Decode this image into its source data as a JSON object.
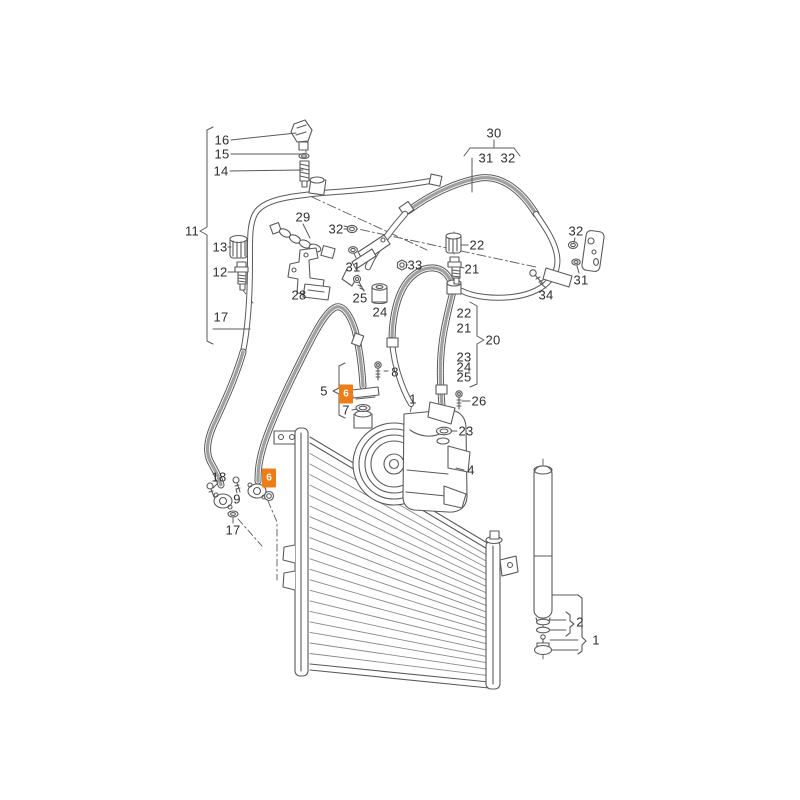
{
  "canvas": {
    "width": 800,
    "height": 800,
    "background": "#ffffff"
  },
  "diagram": {
    "type": "exploded-parts-diagram",
    "subject": "air-conditioning-condenser-compressor-refrigerant-lines",
    "line_color": "#5a5a5a",
    "label_color": "#2e2e2e",
    "highlight_color": "#ed7d17",
    "highlight_text_color": "#ffffff"
  },
  "callouts": [
    {
      "label": "16",
      "x": 222,
      "y": 140
    },
    {
      "label": "15",
      "x": 222,
      "y": 154
    },
    {
      "label": "14",
      "x": 221,
      "y": 171
    },
    {
      "label": "11",
      "x": 192,
      "y": 231
    },
    {
      "label": "13",
      "x": 220,
      "y": 247
    },
    {
      "label": "12",
      "x": 220,
      "y": 272
    },
    {
      "label": "17",
      "x": 221,
      "y": 317
    },
    {
      "label": "29",
      "x": 303,
      "y": 217
    },
    {
      "label": "28",
      "x": 299,
      "y": 295
    },
    {
      "label": "32",
      "x": 336,
      "y": 229
    },
    {
      "label": "31",
      "x": 353,
      "y": 267
    },
    {
      "label": "33",
      "x": 415,
      "y": 265
    },
    {
      "label": "25",
      "x": 360,
      "y": 298
    },
    {
      "label": "24",
      "x": 380,
      "y": 312
    },
    {
      "label": "30",
      "x": 494,
      "y": 133
    },
    {
      "label": "31",
      "x": 486,
      "y": 158
    },
    {
      "label": "32",
      "x": 508,
      "y": 158
    },
    {
      "label": "22",
      "x": 477,
      "y": 245
    },
    {
      "label": "21",
      "x": 472,
      "y": 269
    },
    {
      "label": "32",
      "x": 576,
      "y": 231
    },
    {
      "label": "31",
      "x": 581,
      "y": 280
    },
    {
      "label": "34",
      "x": 546,
      "y": 295
    },
    {
      "label": "22",
      "x": 464,
      "y": 313
    },
    {
      "label": "21",
      "x": 464,
      "y": 328
    },
    {
      "label": "20",
      "x": 493,
      "y": 340
    },
    {
      "label": "23",
      "x": 464,
      "y": 357
    },
    {
      "label": "24",
      "x": 464,
      "y": 367
    },
    {
      "label": "25",
      "x": 464,
      "y": 377
    },
    {
      "label": "26",
      "x": 479,
      "y": 401
    },
    {
      "label": "8",
      "x": 395,
      "y": 372
    },
    {
      "label": "5",
      "x": 324,
      "y": 391
    },
    {
      "label": "7",
      "x": 346,
      "y": 410
    },
    {
      "label": "1",
      "x": 413,
      "y": 399
    },
    {
      "label": "23",
      "x": 466,
      "y": 431
    },
    {
      "label": "4",
      "x": 471,
      "y": 470
    },
    {
      "label": "18",
      "x": 219,
      "y": 477
    },
    {
      "label": "9",
      "x": 237,
      "y": 499
    },
    {
      "label": "17",
      "x": 233,
      "y": 530
    },
    {
      "label": "2",
      "x": 580,
      "y": 622
    },
    {
      "label": "1",
      "x": 596,
      "y": 640
    }
  ],
  "highlights": [
    {
      "label": "6",
      "x": 346,
      "y": 394
    },
    {
      "label": "6",
      "x": 269,
      "y": 478
    }
  ]
}
